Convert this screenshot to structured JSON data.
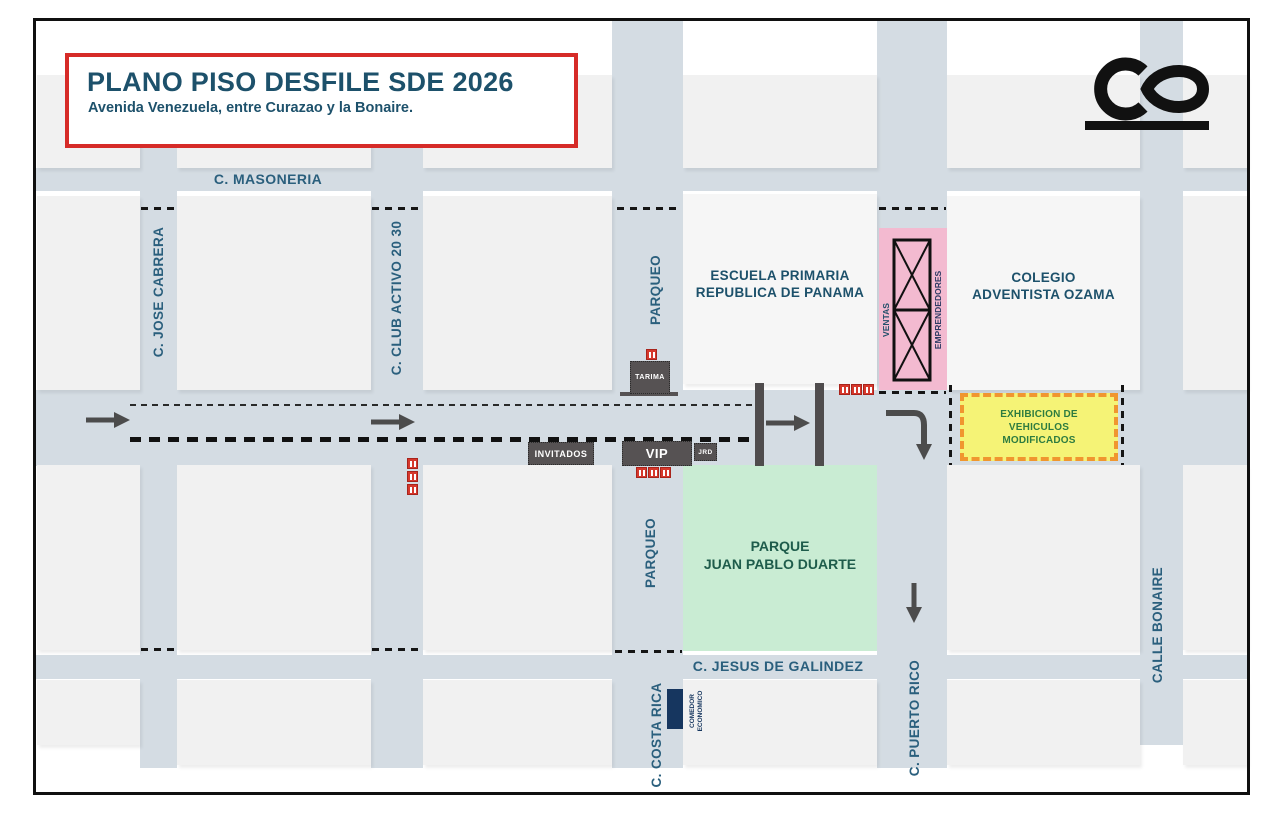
{
  "header": {
    "title": "PLANO PISO DESFILE SDE 2026",
    "subtitle": "Avenida Venezuela, entre Curazao y la Bonaire."
  },
  "streets": {
    "masoneria": "C. MASONERIA",
    "jose_cabrera": "C. JOSE CABRERA",
    "club_activo": "C. CLUB ACTIVO 20 30",
    "parqueo_north": "PARQUEO",
    "parqueo_south": "PARQUEO",
    "jesus_de_galindez": "C. JESUS DE GALINDEZ",
    "costa_rica": "C. COSTA RICA",
    "puerto_rico": "C. PUERTO RICO",
    "bonaire": "CALLE BONAIRE"
  },
  "buildings": {
    "escuela": {
      "line1": "ESCUELA PRIMARIA",
      "line2": "REPUBLICA DE PANAMA"
    },
    "colegio": {
      "line1": "COLEGIO",
      "line2": "ADVENTISTA OZAMA"
    },
    "parque": {
      "line1": "PARQUE",
      "line2": "JUAN PABLO DUARTE"
    }
  },
  "zones": {
    "ventas": "VENTAS",
    "emprendedores": "EMPRENDEDORES",
    "exhibicion": {
      "line1": "EXHIBICION DE",
      "line2": "VEHICULOS",
      "line3": "MODIFICADOS"
    },
    "tarima": "TARIMA",
    "invitados": "INVITADOS",
    "vip": "VIP",
    "jrd": "JRD",
    "comedor": {
      "line1": "COMEDOR",
      "line2": "ECONOMICO"
    }
  },
  "colors": {
    "street": "#d4dce3",
    "block": "#f1f1f1",
    "street_label_blue": "#2a5f7d",
    "title_navy": "#1d516b",
    "accent_red": "#d62b28",
    "park_green_bg": "#c9ecd3",
    "park_green_text": "#1e5c4b",
    "vendors_pink": "#f3bad0",
    "exhibit_yellow": "#f5f376",
    "exhibit_orange_border": "#f0962f",
    "exhibit_green_text": "#2e7c40",
    "dark_box_gray": "#565253",
    "comedor_navy": "#16365f",
    "restroom_red": "#d6382c"
  }
}
